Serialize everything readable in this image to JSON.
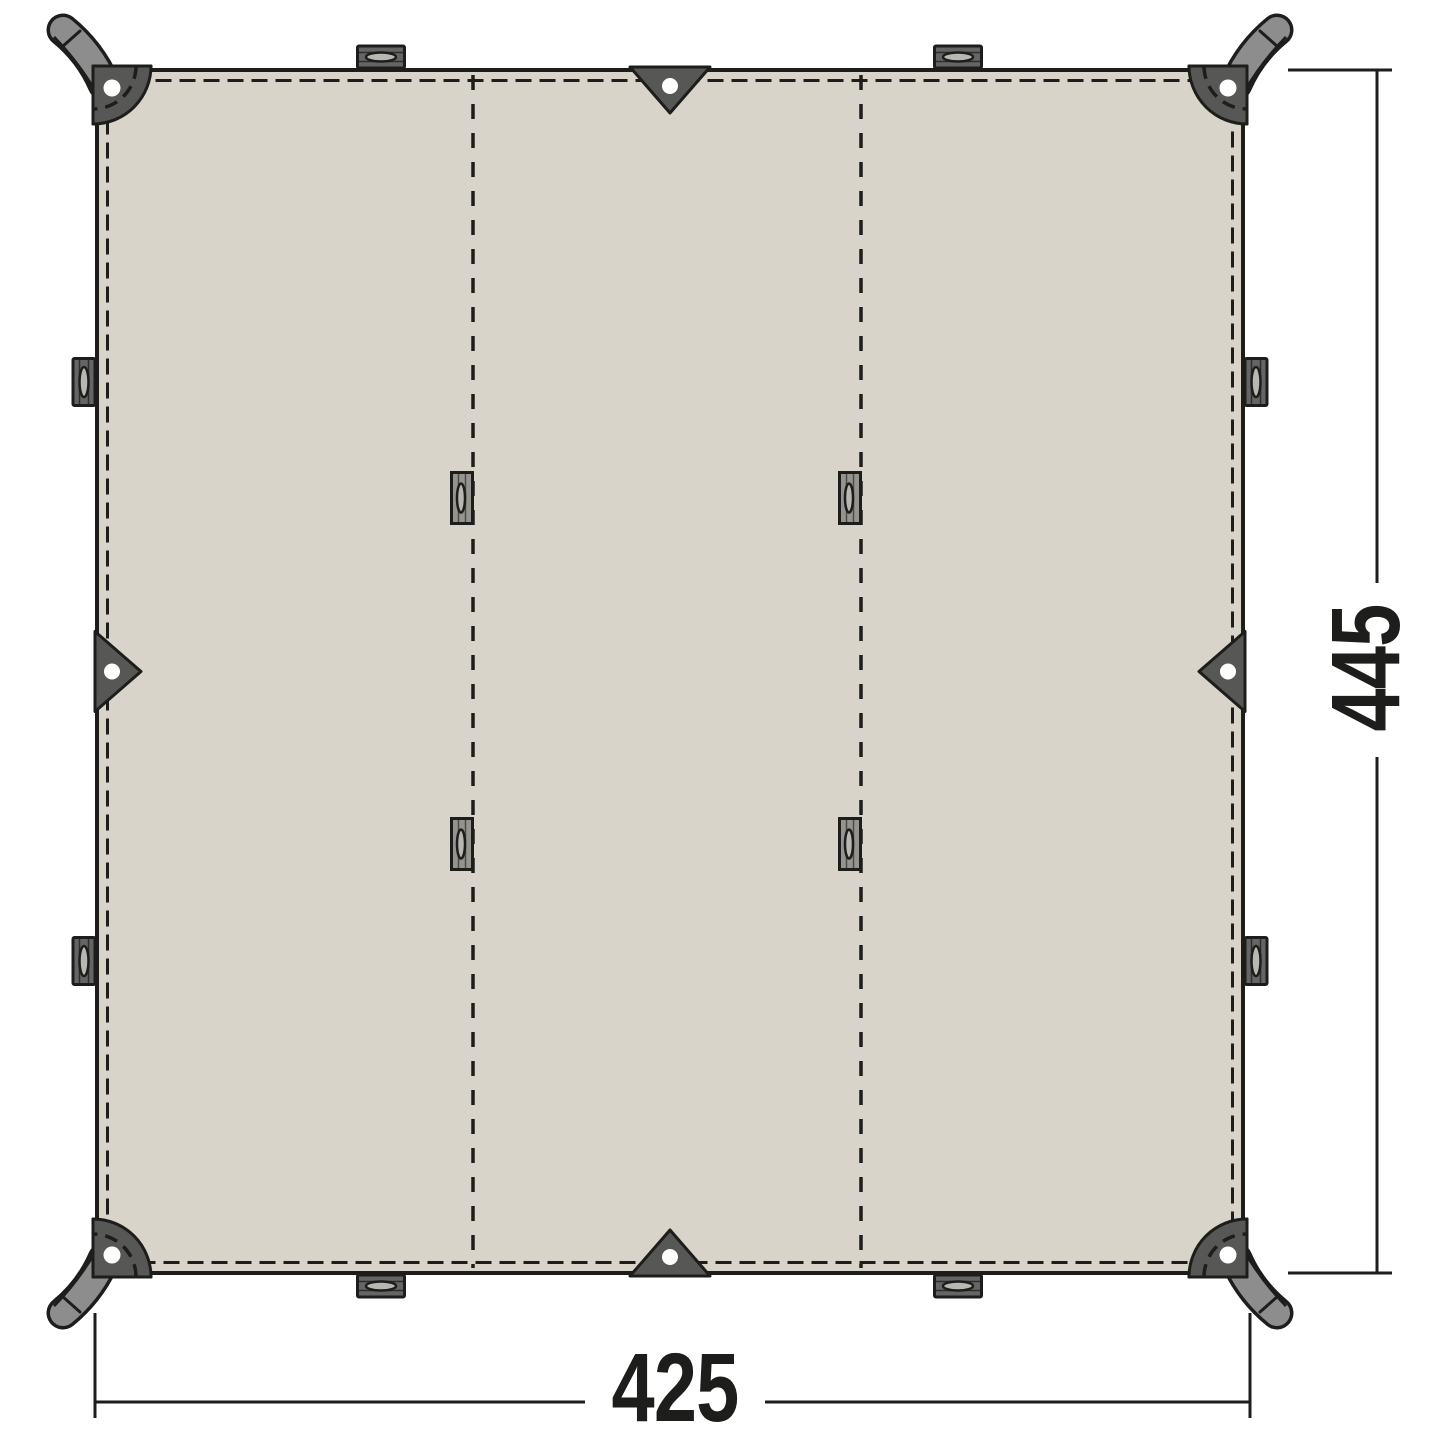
{
  "dimensions": {
    "width": "425",
    "height": "445"
  },
  "colors": {
    "background": "#ffffff",
    "fabric": "#d8d4ca",
    "outline": "#1d1d1b",
    "patch": "#575756",
    "strap": "#8d8d8d",
    "edge_loop": "#656565",
    "seam_loop": "#96948e",
    "loop_slot": "#b9b7b2",
    "grommet": "#ffffff"
  }
}
